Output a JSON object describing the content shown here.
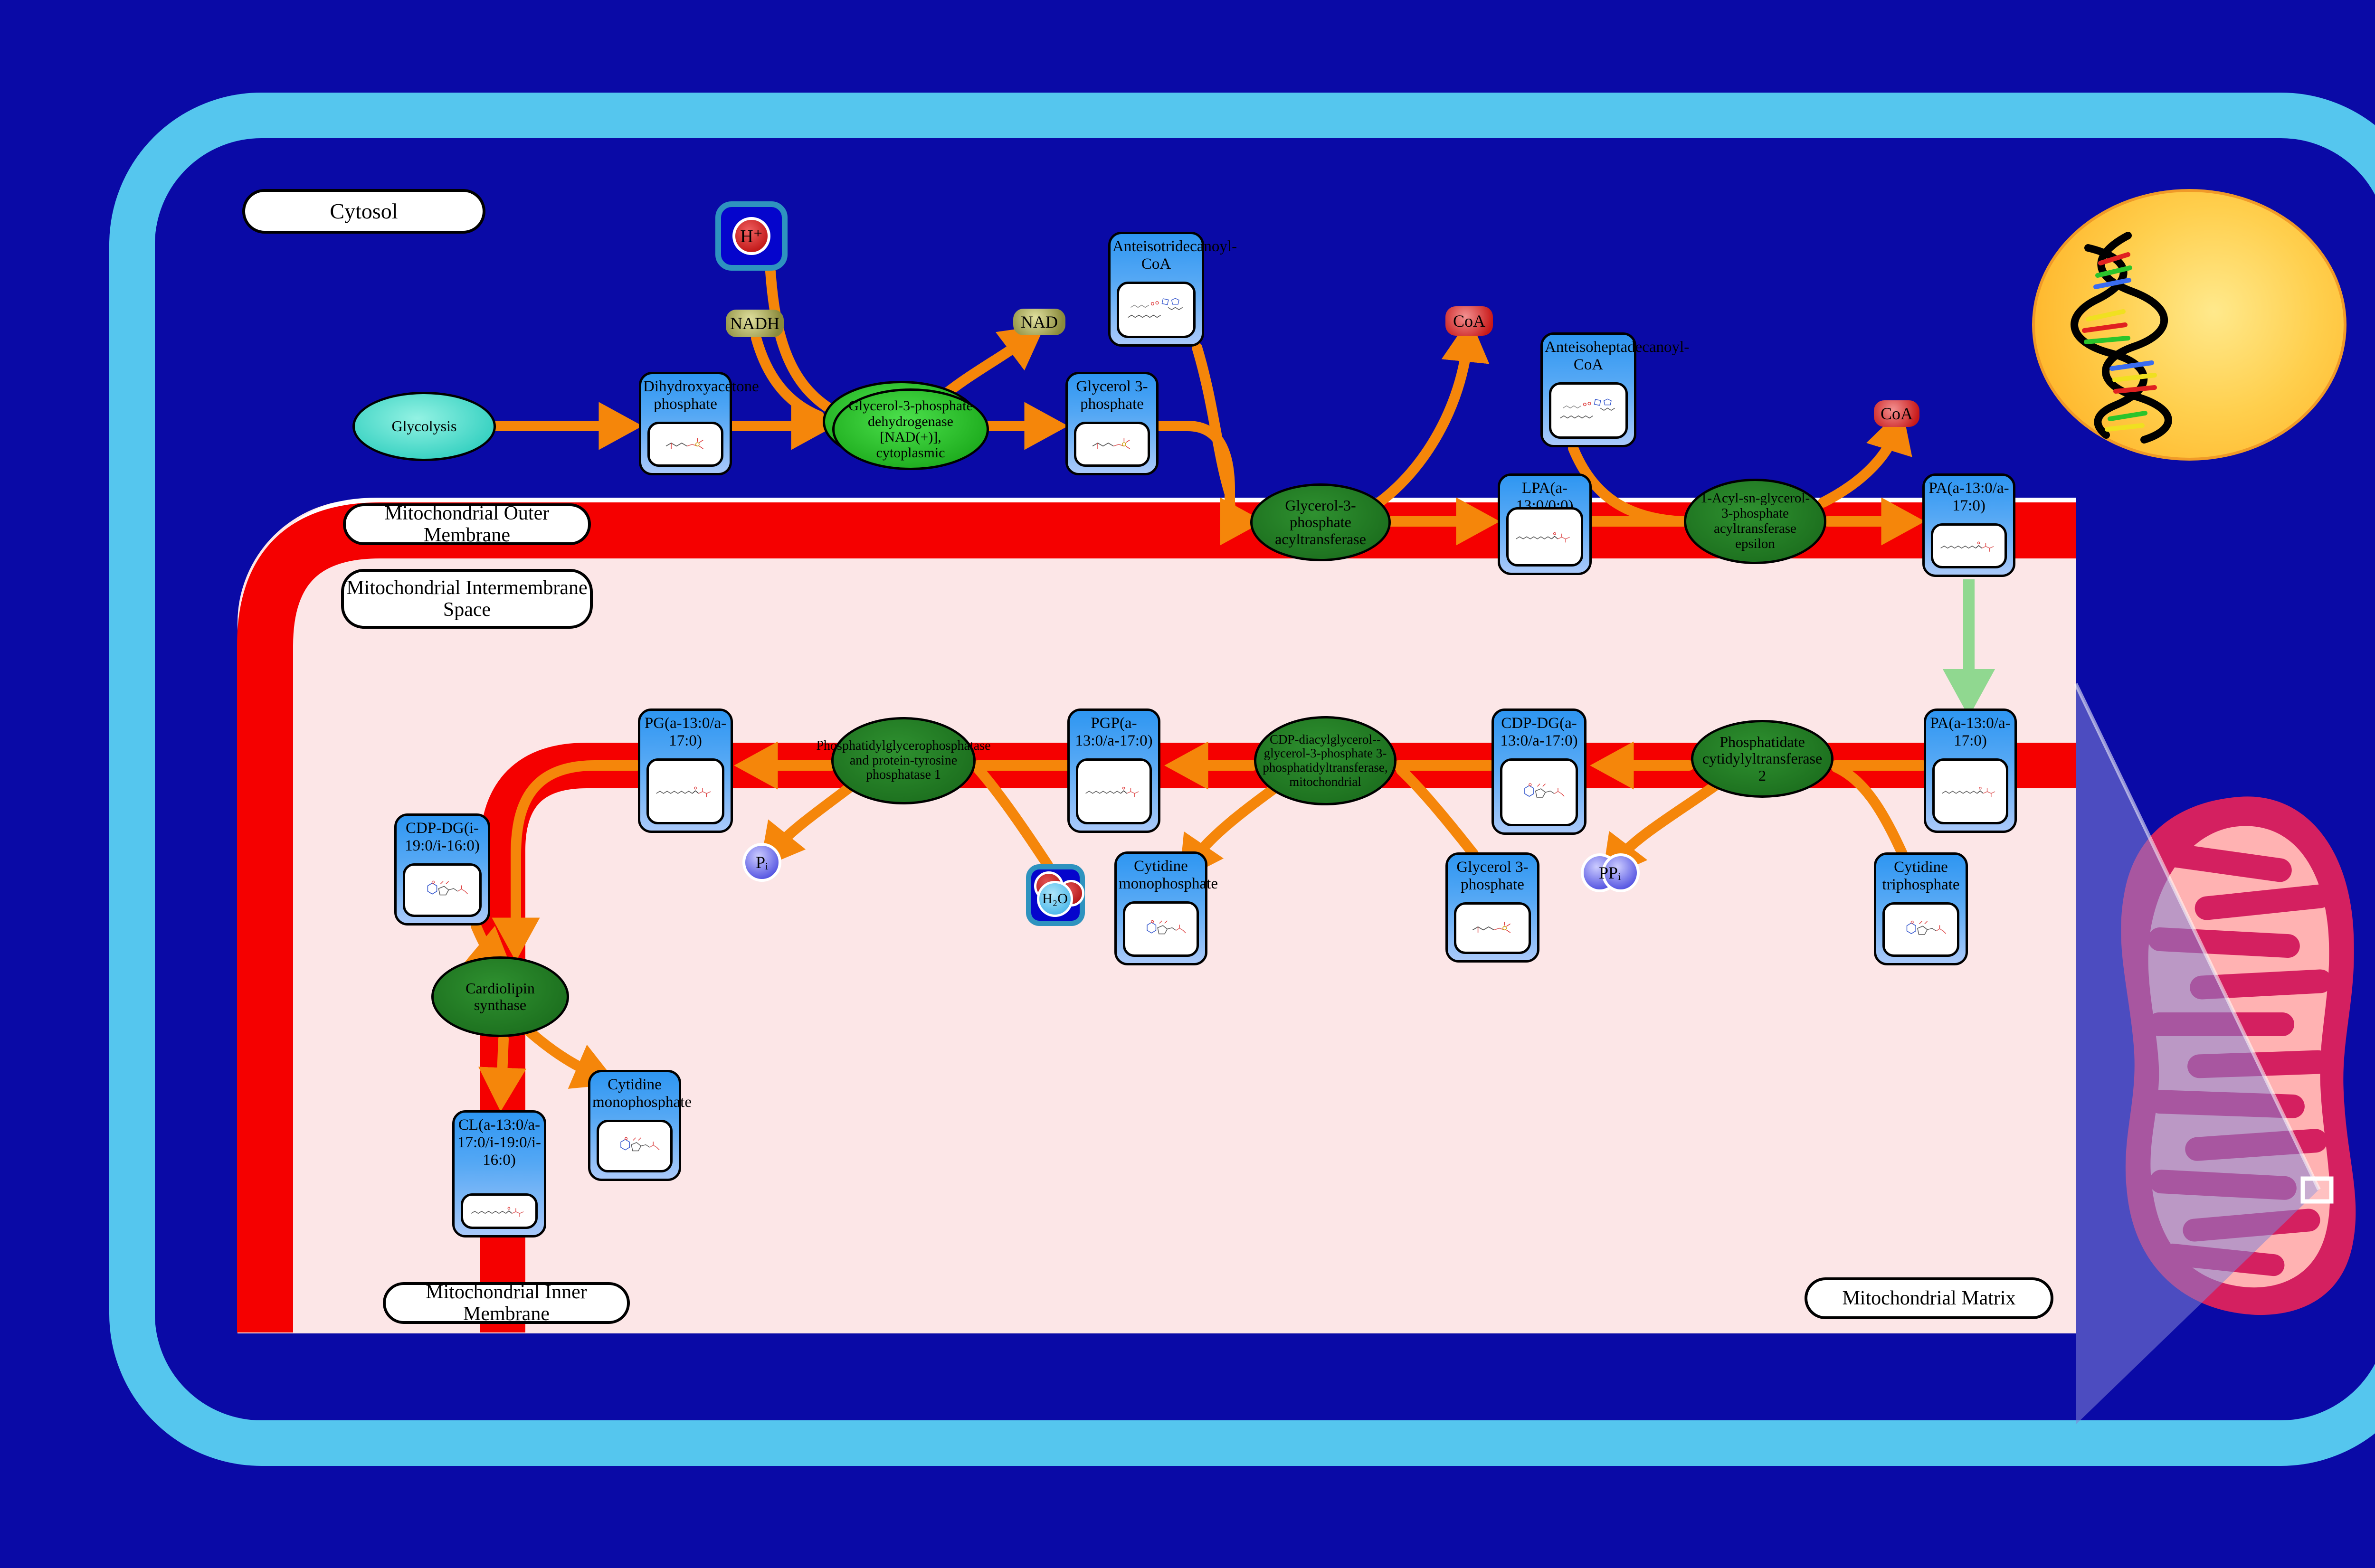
{
  "colors": {
    "background_blue": "#0a0aa6",
    "cell_membrane_blue": "#55c6ee",
    "intermembrane_pink": "#fce6e7",
    "membrane_red": "#f50000",
    "arrow_orange": "#f5860a",
    "arrow_green": "#90d890",
    "box_header_blue": "#2e96f2",
    "enzyme_green_dark": "#1c6f1e",
    "enzyme_green_bright": "#1aa81a",
    "nucleus_yellow": "#ffcf4d",
    "mitochondrion_crimson": "#d42060",
    "mitochondrion_pink": "#ffb2b2"
  },
  "labels": {
    "cytosol": "Cytosol",
    "outer_membrane": "Mitochondrial Outer Membrane",
    "intermembrane_space": "Mitochondrial Intermembrane Space",
    "inner_membrane": "Mitochondrial Inner Membrane",
    "matrix": "Mitochondrial Matrix"
  },
  "process": {
    "glycolysis": "Glycolysis"
  },
  "enzymes": {
    "gpd_cytoplasmic": "Glycerol-3-phosphate dehydrogenase [NAD(+)], cytoplasmic",
    "gpat": "Glycerol-3-phosphate acyltransferase",
    "agpat_epsilon": "1-Acyl-sn-glycerol-3-phosphate acyltransferase epsilon",
    "pcyt2": "Phosphatidate cytidylyltransferase 2",
    "pgs1": "CDP-diacylglycerol--glycerol-3-phosphate 3-phosphatidyltransferase, mitochondrial",
    "ptpmt1": "Phosphatidylglycerophosphatase and protein-tyrosine phosphatase 1",
    "cls": "Cardiolipin synthase"
  },
  "boxes": {
    "dhap": "Dihydroxyacetone phosphate",
    "g3p_top": "Glycerol 3-phosphate",
    "anteisotridecanoyl_coa": "Anteisotridecanoyl-CoA",
    "anteisoheptadecanoyl_coa": "Anteisoheptadecanoyl-CoA",
    "lpa": "LPA(a-13:0/0:0)",
    "pa_outer": "PA(a-13:0/a-17:0)",
    "pa_inner": "PA(a-13:0/a-17:0)",
    "cdp_dg_a": "CDP-DG(a-13:0/a-17:0)",
    "pgp": "PGP(a-13:0/a-17:0)",
    "pg": "PG(a-13:0/a-17:0)",
    "cdp_dg_i": "CDP-DG(i-19:0/i-16:0)",
    "cl": "CL(a-13:0/a-17:0/i-19:0/i-16:0)",
    "cmp_mid": "Cytidine monophosphate",
    "cmp_left": "Cytidine monophosphate",
    "g3p_bottom": "Glycerol 3-phosphate",
    "ctp": "Cytidine triphosphate"
  },
  "small_molecules": {
    "nadh": "NADH",
    "nad": "NAD",
    "coa_1": "CoA",
    "coa_2": "CoA",
    "h_plus": "H⁺",
    "h2o": "H₂O",
    "pi": "Pᵢ",
    "ppi": "PPᵢ"
  }
}
